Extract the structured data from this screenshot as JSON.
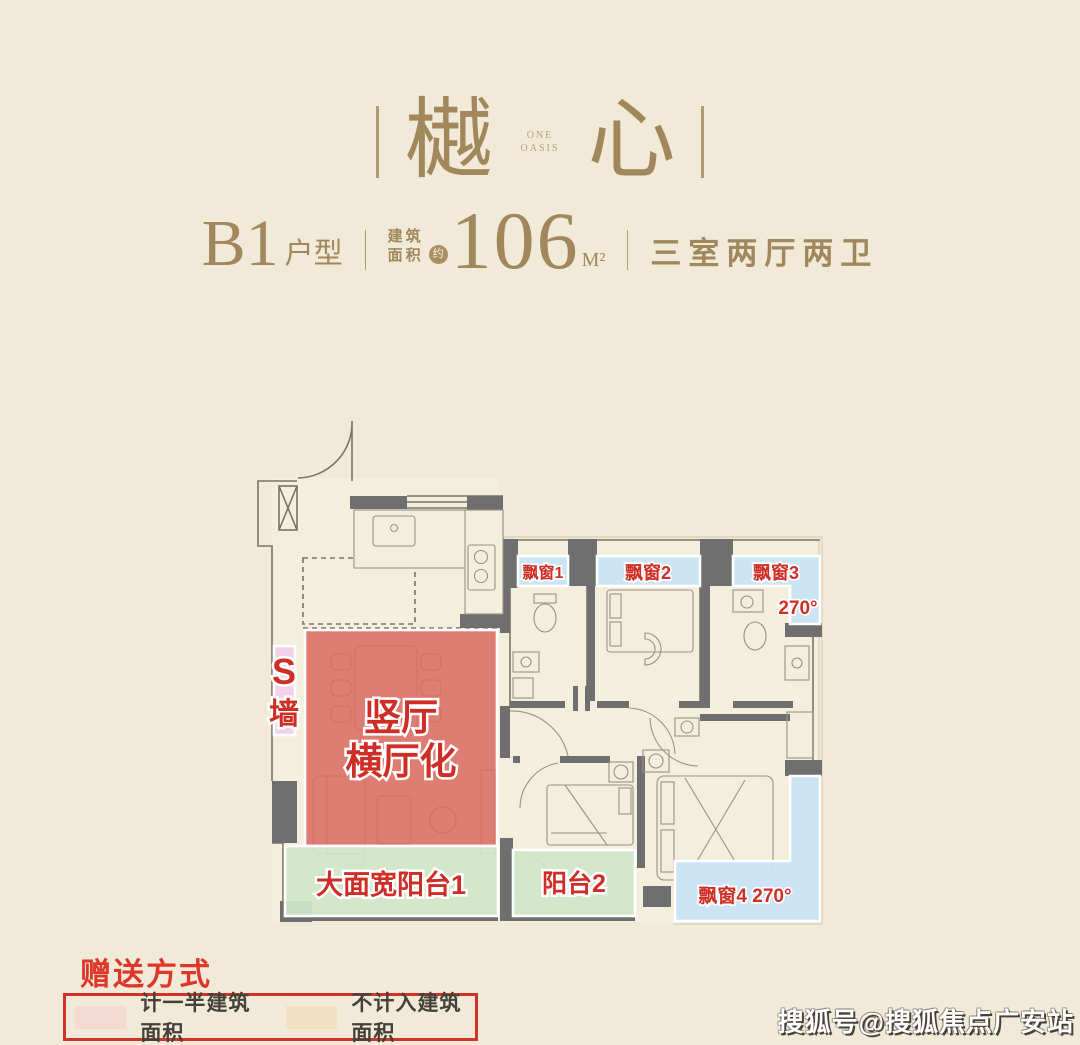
{
  "page": {
    "background": "#f1ead8"
  },
  "header": {
    "logo": {
      "char_left": "樾",
      "char_right": "心",
      "subtext_line1": "ONE",
      "subtext_line2": "OASIS",
      "color": "#a1875c"
    },
    "spec": {
      "model": "B1",
      "model_suffix": "户型",
      "area_label_line1": "建筑",
      "area_label_line2": "面积",
      "area_approx_badge": "约",
      "area_value": "106",
      "area_unit": "M²",
      "layout_desc": "三室两厅两卫"
    }
  },
  "floor_plan": {
    "wall_color": "#6f6f6f",
    "label_color": "#cf2e26",
    "overlays": {
      "living": {
        "label_line1": "竖厅",
        "label_line2": "横厅化",
        "color": "#d96a60"
      },
      "s_wall": {
        "label_line1": "S",
        "label_line2": "墙",
        "color": "#f2cdea"
      },
      "balcony1": {
        "label": "大面宽阳台1",
        "color": "#cfe7c9"
      },
      "balcony2": {
        "label": "阳台2",
        "color": "#cfe7c9"
      },
      "bay1": {
        "label": "飘窗1",
        "color": "#c9e4f4"
      },
      "bay2": {
        "label": "飘窗2",
        "color": "#c9e4f4"
      },
      "bay3": {
        "label": "飘窗3",
        "angle": "270°",
        "color": "#c9e4f4"
      },
      "bay4": {
        "label": "飘窗4 270°",
        "color": "#c9e4f4"
      }
    }
  },
  "legend": {
    "title": "赠送方式",
    "border_color": "#d23327",
    "items": [
      {
        "swatch_color": "#f5d9d3",
        "label": "计一半建筑面积"
      },
      {
        "swatch_color": "#f3dfc4",
        "label": "不计入建筑面积"
      }
    ]
  },
  "watermark": {
    "text": "搜狐号@搜狐焦点广安站"
  }
}
